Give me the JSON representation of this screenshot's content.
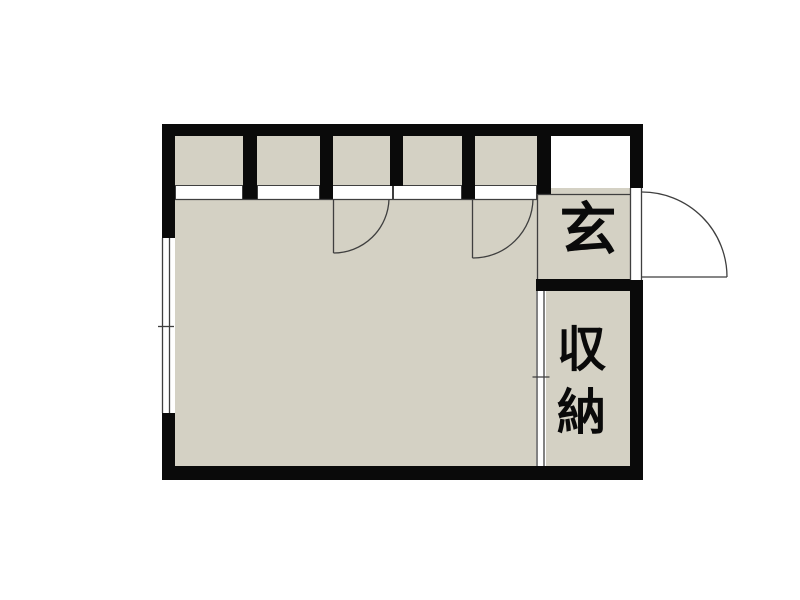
{
  "floorplan": {
    "type": "japanese-apartment-floor-plan",
    "labels": {
      "genkan": "玄",
      "storage": "収納"
    },
    "colors": {
      "wall": "#0a0a0a",
      "floor": "#d4d1c4",
      "line": "#3f3f3f",
      "background": "#ffffff"
    },
    "closet_cell_count": 5,
    "swing_door_count": 3,
    "sliding_panel_count": 2
  }
}
